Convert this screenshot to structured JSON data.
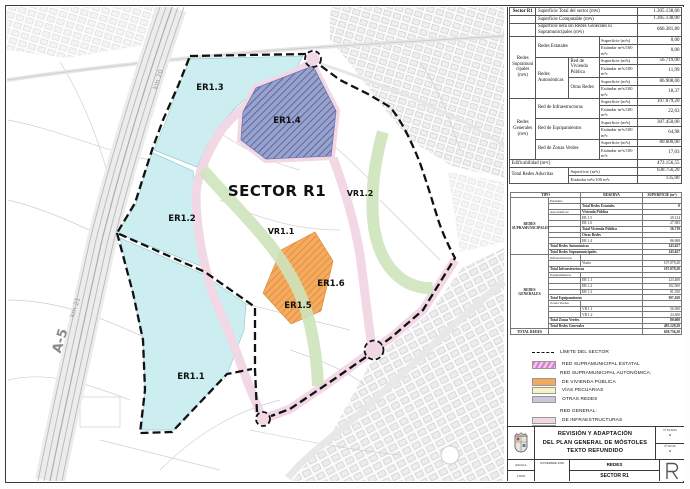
{
  "map": {
    "labels": {
      "sector": "SECTOR R1",
      "er13": "ER1.3",
      "er14": "ER1.4",
      "er12": "ER1.2",
      "er11": "ER1.1",
      "er15": "ER1.5",
      "er16": "ER1.6",
      "vr11": "VR1.1",
      "vr12": "VR1.2",
      "a5": "A-5",
      "km20": "km 20",
      "km21": "km 21"
    },
    "colors": {
      "equipamientos": "#cdeef0",
      "zonas_verdes": "#cfe4bc",
      "infraestructuras": "#f2d7e4",
      "vivienda_publica": "#f4a95e",
      "otras_redes": "#98a2cb",
      "boundary": "#111111"
    }
  },
  "table1": {
    "title": "Sector R1",
    "sup_label": "Superficie (m²s)",
    "est_label": "Estándar m²s/100 m²c",
    "rows": {
      "total": {
        "l": "Superficie Total del sector  (m²s)",
        "v": "1.305.138,00"
      },
      "comp": {
        "l": "Superficie Computable (m²s)",
        "v": "1.305.138,00"
      },
      "neta": {
        "l": "Superficie neta sin Redes Generales ni Supramunicipales (m²s)",
        "v": "666.381,80"
      },
      "supra": {
        "g": "Redes Supramunicipales (m²s)",
        "estatales": "Redes Estatales",
        "est_sup": "0,00",
        "est_est": "0,00",
        "auto": "Redes Autonómicas",
        "viv": "Red de Vivienda Pública",
        "viv_sup": "56.719,00",
        "viv_est": "11,99",
        "otras": "Otras Redes",
        "otras_sup": "86.908,00",
        "otras_est": "18,37"
      },
      "gen": {
        "g": "Redes Generales (m²s)",
        "infra": "Red de Infraestructuras",
        "infra_sup": "107.079,20",
        "infra_est": "22,63",
        "equip": "Red de Equipamientos",
        "equip_sup": "307.450,00",
        "equip_est": "64,98",
        "verde": "Red de Zonas Verdes",
        "verde_sup": "80.600,00",
        "verde_est": "17,03"
      },
      "edif": {
        "l": "Edificabilidad (m²c)",
        "v": "473.156,55"
      },
      "adscritas": {
        "l": "Total Redes Adscritas",
        "sup": "638.756,20",
        "est": "135,00"
      }
    }
  },
  "table2": {
    "h_tipo": "TIPO",
    "h_reserva": "RESERVA",
    "h_sup": "SUPERFICIE (m²)",
    "rows": [
      [
        {
          "t": "REDES SUPRAMUNICIPALES",
          "rs": 10,
          "cls": "grp"
        },
        {
          "t": "Estatales",
          "cls": "sub"
        },
        {
          "t": ""
        },
        {
          "t": ""
        }
      ],
      [
        {
          "t": ""
        },
        {
          "t": "Total Redes Estatales",
          "cls": "tot"
        },
        {
          "t": "0",
          "cls": "val tot"
        }
      ],
      [
        {
          "t": "Autonómicas",
          "cls": "sub"
        },
        {
          "t": "Vivienda Pública",
          "cls": "hdc"
        },
        {
          "t": ""
        }
      ],
      [
        {
          "t": ""
        },
        {
          "t": "ER 1.5"
        },
        {
          "t": "29.134",
          "cls": "val"
        }
      ],
      [
        {
          "t": ""
        },
        {
          "t": "ER 1.6"
        },
        {
          "t": "27.585",
          "cls": "val"
        }
      ],
      [
        {
          "t": ""
        },
        {
          "t": "Total Vivienda Pública",
          "cls": "tot"
        },
        {
          "t": "56.719",
          "cls": "val tot"
        }
      ],
      [
        {
          "t": ""
        },
        {
          "t": "Otras Redes",
          "cls": "hdc"
        },
        {
          "t": ""
        }
      ],
      [
        {
          "t": ""
        },
        {
          "t": "ER 1.4"
        },
        {
          "t": "86.908",
          "cls": "val"
        }
      ],
      [
        {
          "t": "Total Redes Autonómicas",
          "cs": 2,
          "cls": "tot"
        },
        {
          "t": "143.627",
          "cls": "val tot"
        }
      ],
      [
        {
          "t": "Total Redes Supramunicipales",
          "cs": 2,
          "cls": "tot"
        },
        {
          "t": "143.627",
          "cls": "val tot"
        }
      ],
      [
        {
          "t": "REDES GENERALES",
          "rs": 13,
          "cls": "grp"
        },
        {
          "t": "Infraestructuras",
          "cls": "sub"
        },
        {
          "t": ""
        },
        {
          "t": ""
        }
      ],
      [
        {
          "t": ""
        },
        {
          "t": "Viario"
        },
        {
          "t": "107.079,20",
          "cls": "val"
        }
      ],
      [
        {
          "t": "Total Infraestructuras",
          "cs": 2,
          "cls": "tot"
        },
        {
          "t": "107.079,20",
          "cls": "val tot"
        }
      ],
      [
        {
          "t": "Equipamientos",
          "cls": "sub"
        },
        {
          "t": ""
        },
        {
          "t": ""
        }
      ],
      [
        {
          "t": ""
        },
        {
          "t": "ER 1.1"
        },
        {
          "t": "123.400",
          "cls": "val"
        }
      ],
      [
        {
          "t": ""
        },
        {
          "t": "ER 1.2"
        },
        {
          "t": "102.500",
          "cls": "val"
        }
      ],
      [
        {
          "t": ""
        },
        {
          "t": "ER 1.3"
        },
        {
          "t": "81.550",
          "cls": "val"
        }
      ],
      [
        {
          "t": "Total Equipamientos",
          "cs": 2,
          "cls": "tot"
        },
        {
          "t": "307.450",
          "cls": "val tot"
        }
      ],
      [
        {
          "t": "Zonas Verdes",
          "cls": "sub"
        },
        {
          "t": ""
        },
        {
          "t": ""
        }
      ],
      [
        {
          "t": ""
        },
        {
          "t": "VR 1.1"
        },
        {
          "t": "56.300",
          "cls": "val"
        }
      ],
      [
        {
          "t": ""
        },
        {
          "t": "VR 1.2"
        },
        {
          "t": "24.300",
          "cls": "val"
        }
      ],
      [
        {
          "t": "Total Zonas Verdes",
          "cs": 2,
          "cls": "tot"
        },
        {
          "t": "80.600",
          "cls": "val tot"
        }
      ],
      [
        {
          "t": "Total Redes Generales",
          "cs": 2,
          "cls": "tot"
        },
        {
          "t": "495.129,20",
          "cls": "val tot"
        }
      ],
      [
        {
          "t": "TOTAL REDES",
          "cls": "grp tot"
        },
        {
          "t": "",
          "cs": 2
        },
        {
          "t": "638.756,20",
          "cls": "val tot"
        }
      ]
    ]
  },
  "legend": {
    "items": [
      {
        "label": "LÍMITE DEL SECTOR"
      },
      {
        "label": "RED SUPRAMUNICIPAL ESTATAL",
        "color": "#d77fcf"
      },
      {
        "label": "RED SUPRAMUNICIPAL AUTONÓMICA:"
      },
      {
        "label": "DE VIVIENDA PÚBLICA",
        "color": "#f4a95e"
      },
      {
        "label": "VÍAS PECUARIAS",
        "color": "#f6f3c5"
      },
      {
        "label": "OTRAS REDES",
        "color": "#c7c9d9"
      },
      {
        "label": "RED GENERAL:"
      },
      {
        "label": "DE INFRAESTRUCTURAS",
        "color": "#f2d7e4"
      },
      {
        "label": "DE EQUIPAMIENTOS",
        "color": "#cdebee"
      },
      {
        "label": "DE ZONAS VERDES",
        "color": "#cfe4bc"
      }
    ]
  },
  "titleblock": {
    "title_line1": "REVISIÓN Y ADAPTACIÓN",
    "title_line2": "DEL PLAN GENERAL DE MÓSTOLES",
    "title_line3": "TEXTO REFUNDIDO",
    "subject": "REDES",
    "sheet": "SECTOR R1",
    "scale_label": "ESCALA",
    "scale_value": "1:5000",
    "date": "NOVIEMBRE 2008",
    "plano_label": "Nº PLANO",
    "plano_value": "-",
    "hoja_label": "Nº HOJA",
    "hoja_value": "-"
  }
}
